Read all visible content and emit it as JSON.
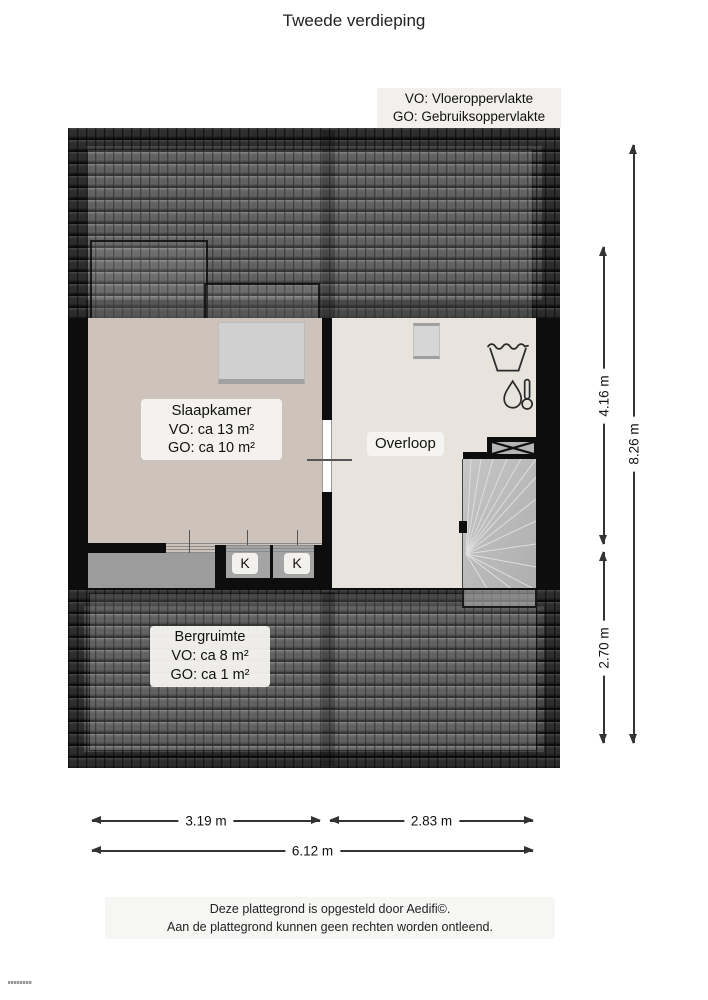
{
  "title": "Tweede verdieping",
  "legend": {
    "line1": "VO: Vloeroppervlakte",
    "line2": "GO: Gebruiksoppervlakte"
  },
  "rooms": {
    "slaapkamer": {
      "name": "Slaapkamer",
      "vo": "VO: ca 13 m²",
      "go": "GO: ca 10 m²"
    },
    "overloop": {
      "name": "Overloop"
    },
    "bergruimte": {
      "name": "Bergruimte",
      "vo": "VO: ca 8 m²",
      "go": "GO: ca 1 m²"
    },
    "closets": {
      "left": "K",
      "right": "K"
    }
  },
  "icons": {
    "laundry": "laundry-tub-icon",
    "heater": "water-heater-icon",
    "duct": "duct-cross-icon",
    "stairs": "winder-staircase"
  },
  "dimensions": {
    "right": [
      {
        "label": "4.16 m"
      },
      {
        "label": "2.70 m"
      },
      {
        "label": "8.26 m"
      }
    ],
    "bottom": [
      {
        "label": "3.19 m"
      },
      {
        "label": "2.83 m"
      },
      {
        "label": "6.12 m"
      }
    ]
  },
  "footer": {
    "line1": "Deze plattegrond is opgesteld door Aedifi©.",
    "line2": "Aan de plattegrond kunnen geen rechten worden ontleend."
  },
  "colors": {
    "wall": "#0d0d0d",
    "slaapkamer_floor": "#cdc3ba",
    "overloop_floor": "#e8e4dd",
    "attic_gray": "#9c9c9c",
    "stairs_gray": "#bcbcbc",
    "roof_dark": "#303030",
    "label_bg": "#f3f1ed"
  }
}
